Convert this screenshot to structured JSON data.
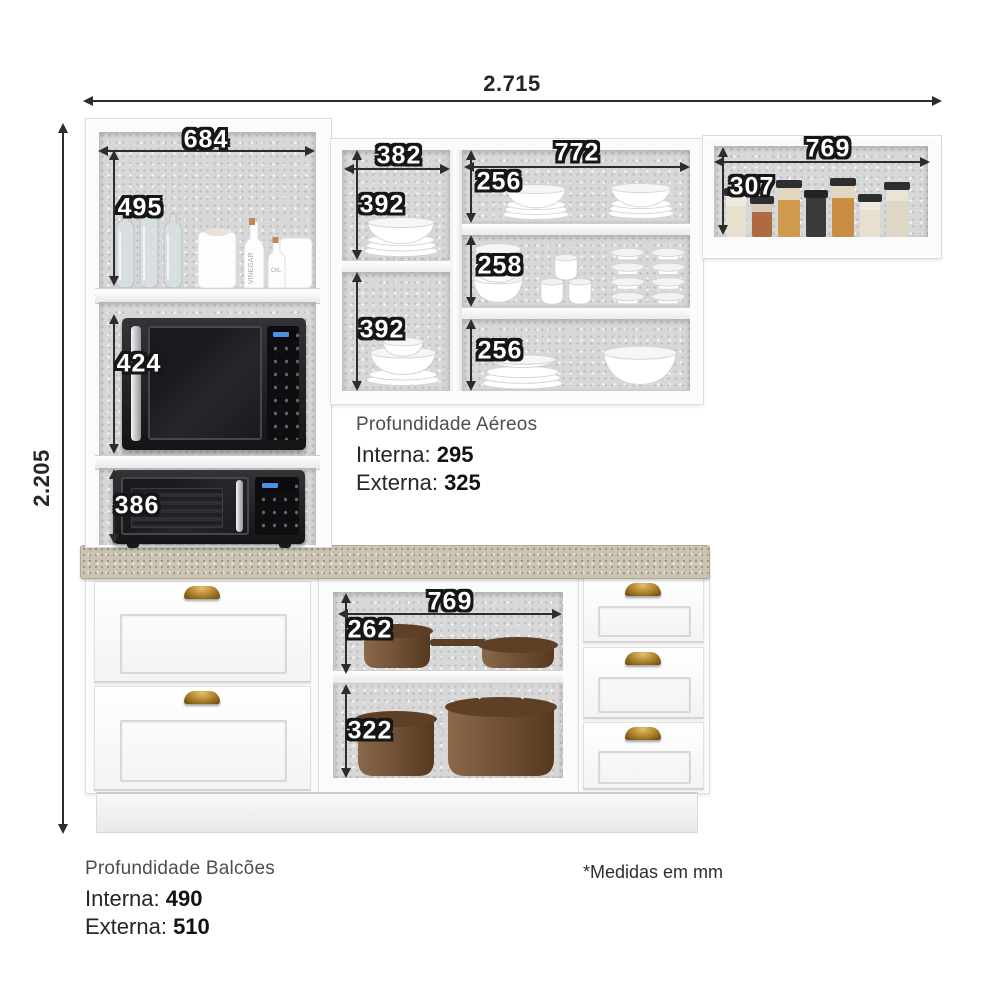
{
  "diagram": {
    "kind": "kitchen-cabinet-dimension-diagram",
    "units_note": "*Medidas em mm"
  },
  "dims": {
    "overall_width": "2.715",
    "overall_height": "2.205",
    "tall_width": "684",
    "tall_top": "495",
    "tall_mid": "424",
    "tall_bottom": "386",
    "mid_left_width": "382",
    "mid_left_top": "392",
    "mid_left_bottom": "392",
    "mid_right_width": "772",
    "mid_row1": "256",
    "mid_row2": "258",
    "mid_row3": "256",
    "right_width": "769",
    "right_height": "307",
    "base_width": "769",
    "base_top": "262",
    "base_bottom": "322"
  },
  "notes": {
    "aereos_title": "Profundidade Aéreos",
    "aereos_interna_label": "Interna:",
    "aereos_interna_value": "295",
    "aereos_externa_label": "Externa:",
    "aereos_externa_value": "325",
    "balcoes_title": "Profundidade Balcões",
    "balcoes_interna_label": "Interna:",
    "balcoes_interna_value": "490",
    "balcoes_externa_label": "Externa:",
    "balcoes_externa_value": "510",
    "units_note": "*Medidas em mm"
  },
  "bottles": {
    "vinegar": "VINEGAR",
    "oil": "OIL"
  },
  "colors": {
    "dim_line": "#2d2d2d",
    "interior_gray": "#d8d8d8",
    "counter_beige": "#cbc4b2",
    "pot_brown": "#74523a",
    "handle_bronze": "#a87e2a",
    "appliance_dark": "#1a1a1e"
  }
}
